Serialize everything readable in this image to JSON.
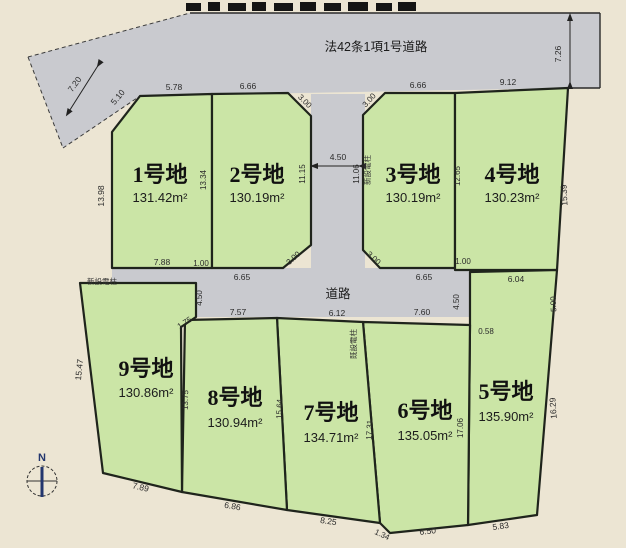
{
  "roads": {
    "top_label": "法42条1項1号道路",
    "middle_label": "道路"
  },
  "plots": [
    {
      "name": "1号地",
      "area": "131.42m²"
    },
    {
      "name": "2号地",
      "area": "130.19m²"
    },
    {
      "name": "3号地",
      "area": "130.19m²"
    },
    {
      "name": "4号地",
      "area": "130.23m²"
    },
    {
      "name": "5号地",
      "area": "135.90m²"
    },
    {
      "name": "6号地",
      "area": "135.05m²"
    },
    {
      "name": "7号地",
      "area": "134.71m²"
    },
    {
      "name": "8号地",
      "area": "130.94m²"
    },
    {
      "name": "9号地",
      "area": "130.86m²"
    }
  ],
  "poles": {
    "new_pole_strip": "新設電柱",
    "new_pole_plot9": "新設電柱",
    "existing_pole": "既設電柱"
  },
  "compass": {
    "label": "N"
  },
  "colors": {
    "background": "#ece5d3",
    "plot_green": "#cbe5a6",
    "road_gray": "#c9cacf",
    "compass_blue": "#23366e"
  },
  "dims": {
    "d720": "7.20",
    "d726": "7.26",
    "d510": "5.10",
    "d578": "5.78",
    "d666a": "6.66",
    "d300a": "3.00",
    "d450top": "4.50",
    "d300b": "3.00",
    "d666b": "6.66",
    "d912": "9.12",
    "d1398": "13.98",
    "d1334": "13.34",
    "d1115": "11.15",
    "d1106": "11.06",
    "d1265": "12.65",
    "d1539": "15.39",
    "d788": "7.88",
    "d100a": "1.00",
    "d300c": "3.00",
    "d300d": "3.00",
    "d665a": "6.65",
    "d665b": "6.65",
    "d100b": "1.00",
    "d604": "6.04",
    "d450l": "4.50",
    "d450r": "4.50",
    "d757": "7.57",
    "d612": "6.12",
    "d760": "7.60",
    "d175": "1.75",
    "d058": "0.58",
    "d500": "5.00",
    "d1547": "15.47",
    "d1375": "13.75",
    "d1564": "15.64",
    "d1731": "17.31",
    "d1706": "17.06",
    "d1629": "16.29",
    "d789": "7.89",
    "d686": "6.86",
    "d825": "8.25",
    "d134": "1.34",
    "d650": "6.50",
    "d583": "5.83"
  }
}
